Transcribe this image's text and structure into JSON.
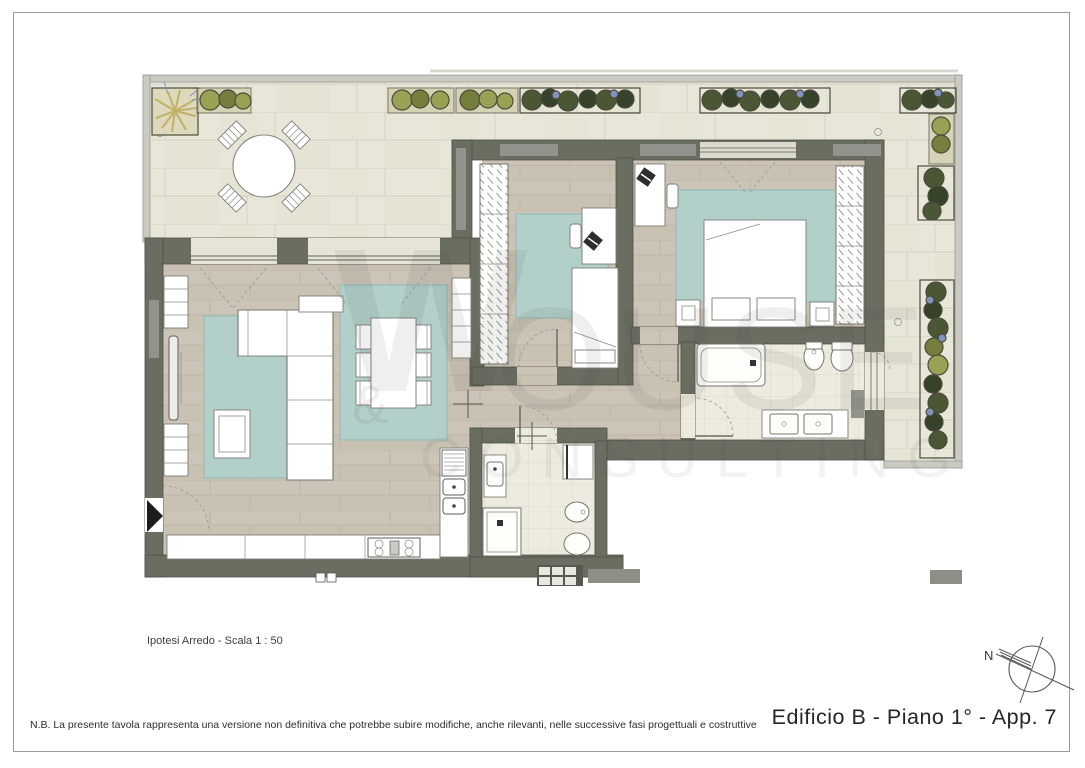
{
  "sheet": {
    "title": "Edificio B - Piano 1° - App. 7",
    "scale_label": "Ipotesi Arredo - Scala  1 : 50",
    "note": "N.B. La presente tavola rappresenta una versione non definitiva che potrebbe subire modifiche, anche rilevanti, nelle successive fasi progettuali e costruttive",
    "compass_label": "N"
  },
  "watermark": {
    "logo": "W",
    "ampersand": "&",
    "word_top": "OUSE",
    "word_bottom": "CONSULTING"
  },
  "colors": {
    "frame": "#9b9b9b",
    "wall": "#6a6e61",
    "wallEdge": "#4e5246",
    "wallInset": "#90948c",
    "parapet": "#c9cac1",
    "parapetLine": "#9a9b92",
    "terrace": "#e8e6d9",
    "terraceJoint": "#d6d3c2",
    "wood": "#ccc4b6",
    "woodJoint": "#bcb2a3",
    "tile": "#edebdf",
    "tileJoint": "#dcd8c7",
    "rug": "#b2cfc9",
    "rugBorder": "#9cc0b9",
    "plantOlive": "#99a155",
    "plantOliveDark": "#767e3e",
    "plantDark": "#4a5634",
    "plantDarker": "#36422a",
    "plantBlue": "#8293c1",
    "palm": "#c1b268",
    "entranceArrow": "#1c1c1c",
    "watermark": "rgba(70,70,70,0.085)",
    "watermark2": "rgba(70,70,70,0.07)"
  }
}
